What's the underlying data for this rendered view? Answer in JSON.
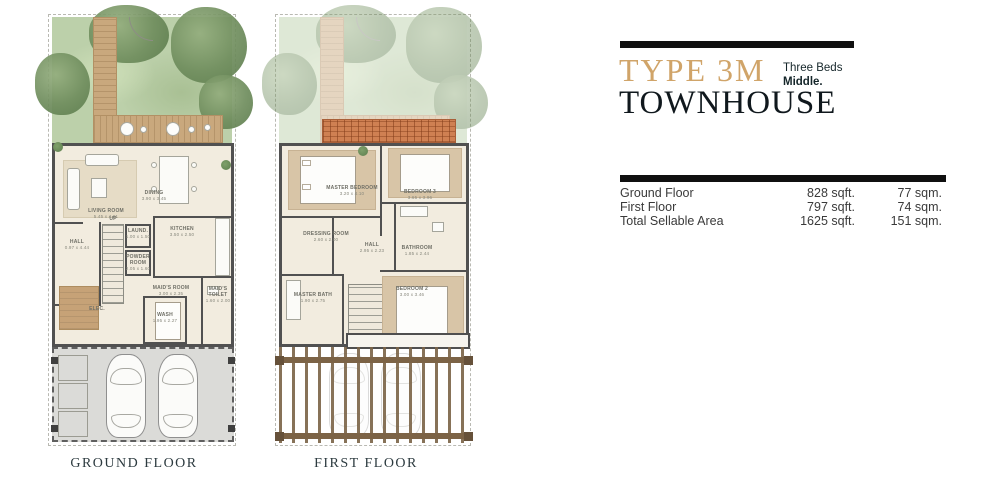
{
  "title_block": {
    "type_label": "TYPE 3M",
    "beds_line": "Three Beds",
    "position_line": "Middle.",
    "product_label": "TOWNHOUSE",
    "accent_color": "#d0a469",
    "bar_color": "#101010"
  },
  "area_table": {
    "rows": [
      {
        "label": "Ground Floor",
        "sqft": "828 sqft.",
        "sqm": "77 sqm."
      },
      {
        "label": "First Floor",
        "sqft": "797 sqft.",
        "sqm": "74 sqm."
      },
      {
        "label": "Total Sellable Area",
        "sqft": "1625 sqft.",
        "sqm": "151 sqm."
      }
    ]
  },
  "plans": {
    "ground": {
      "caption": "GROUND FLOOR",
      "stairs_label": "UP",
      "rooms": {
        "living": {
          "name": "LIVING ROOM",
          "dims": "5.45 x 4.01"
        },
        "dining": {
          "name": "DINING",
          "dims": "3.90 x 3.45"
        },
        "kitchen": {
          "name": "KITCHEN",
          "dims": "3.50 x 2.50"
        },
        "hall": {
          "name": "HALL",
          "dims": "0.97 x 4.44"
        },
        "laundry": {
          "name": "LAUND.",
          "dims": "1.00 x 1.50"
        },
        "powder": {
          "name": "POWDER ROOM",
          "dims": "2.05 x 1.60"
        },
        "maids_room": {
          "name": "MAID'S ROOM",
          "dims": "3.00 x 2.35"
        },
        "maids_toilet": {
          "name": "MAID'S TOILET",
          "dims": "1.60 x 2.00"
        },
        "elec": {
          "name": "ELEC.",
          "dims": ""
        },
        "wash": {
          "name": "WASH",
          "dims": "1.95 x 2.27"
        }
      }
    },
    "first": {
      "caption": "FIRST FLOOR",
      "rooms": {
        "master_bedroom": {
          "name": "MASTER BEDROOM",
          "dims": "3.20 x 4.10"
        },
        "bedroom3": {
          "name": "BEDROOM 3",
          "dims": "3.65 x 3.96"
        },
        "dressing": {
          "name": "DRESSING ROOM",
          "dims": "2.60 x 2.00"
        },
        "hall": {
          "name": "HALL",
          "dims": "2.95 x 2.23"
        },
        "bathroom": {
          "name": "BATHROOM",
          "dims": "1.85 x 2.44"
        },
        "master_bath": {
          "name": "MASTER BATH",
          "dims": "1.90 x 2.75"
        },
        "bedroom2": {
          "name": "BEDROOM 2",
          "dims": "3.00 x 3.46"
        }
      }
    }
  }
}
